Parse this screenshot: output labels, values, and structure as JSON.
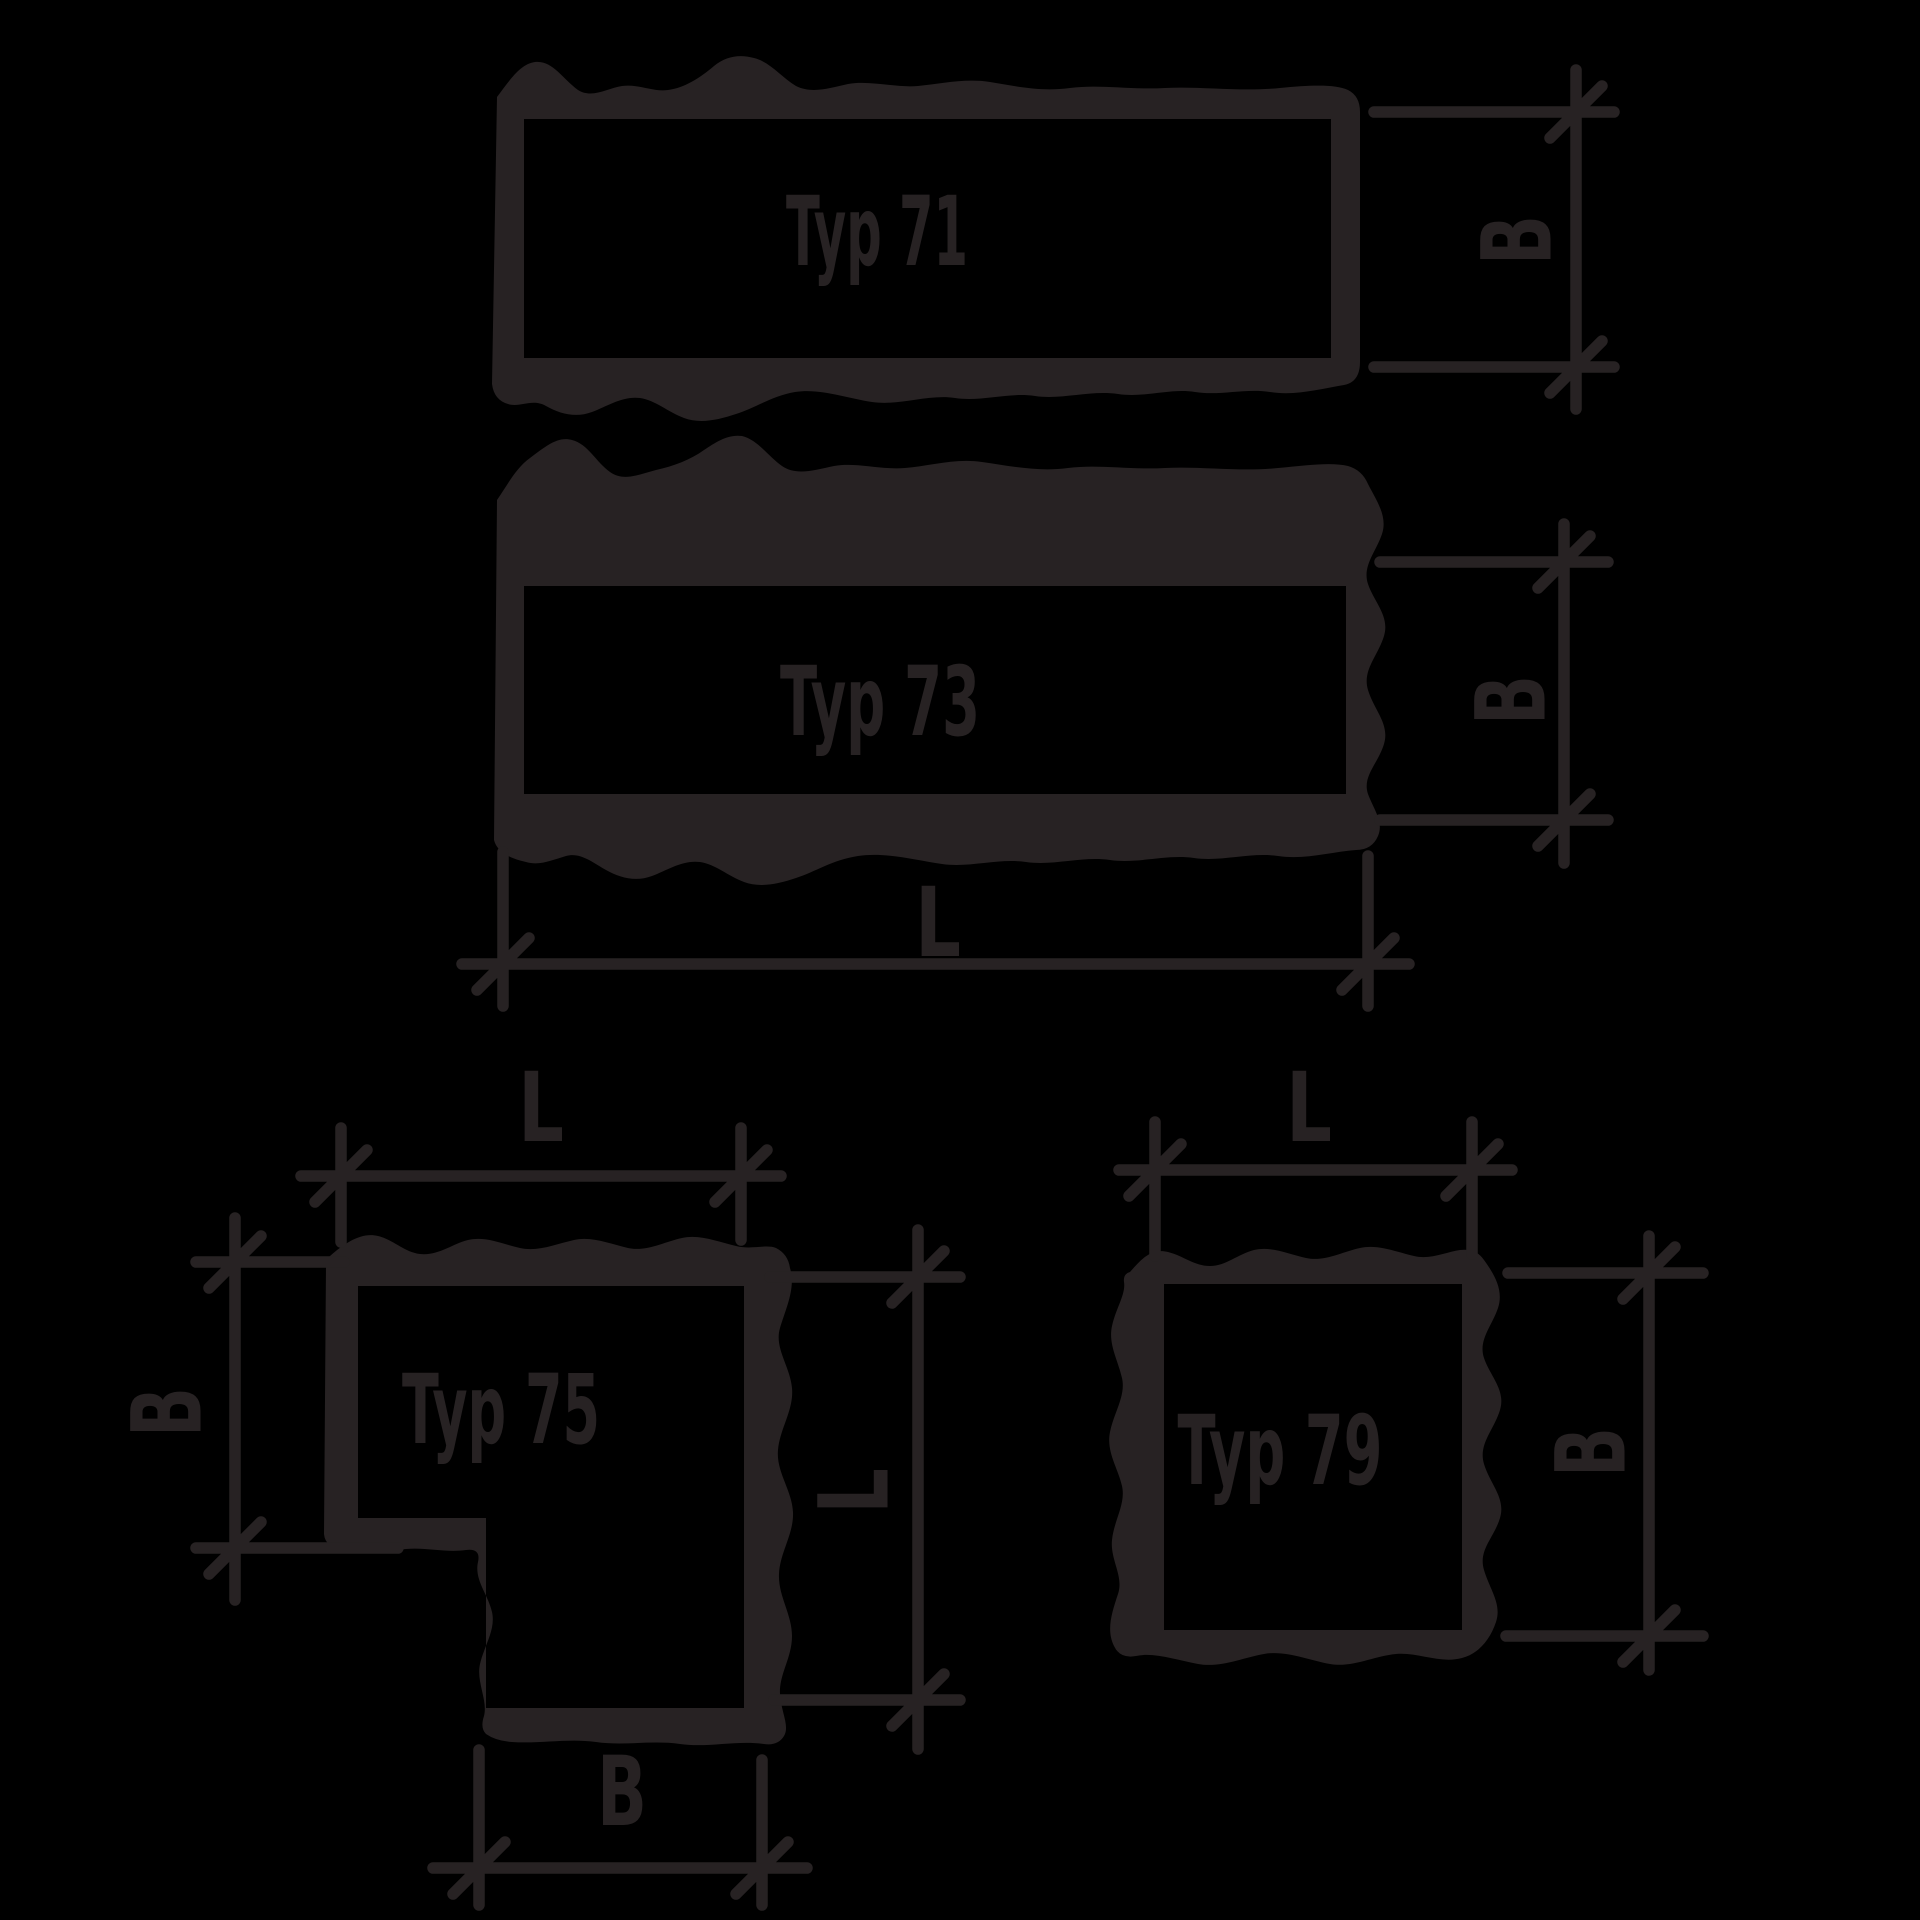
{
  "colors": {
    "background": "#000000",
    "ink": "#272223"
  },
  "typ71": {
    "label": "Typ 71",
    "width_label": "B"
  },
  "typ73": {
    "label": "Typ 73",
    "width_label": "B",
    "length_label": "L"
  },
  "typ75": {
    "label": "Typ 75",
    "length_top_label": "L",
    "width_left_label": "B",
    "length_right_label": "L",
    "width_bottom_label": "B"
  },
  "typ79": {
    "label": "Typ 79",
    "length_top_label": "L",
    "width_right_label": "B"
  }
}
